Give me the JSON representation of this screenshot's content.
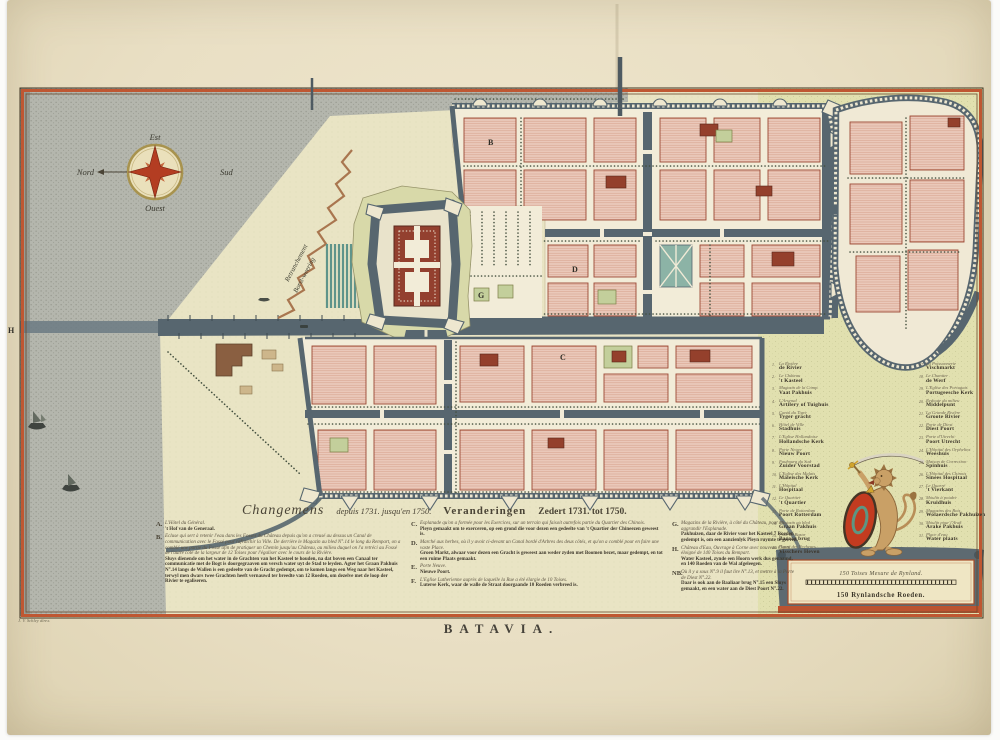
{
  "sheet": {
    "title": "BATAVIA.",
    "signature": "J. V. Schley direx."
  },
  "compass": {
    "east": "Est",
    "north": "Nord",
    "south": "Sud",
    "west": "Ouest"
  },
  "map_labels": {
    "retranchement_fr": "Retranchement",
    "retranchement_nl": "Borst-weering",
    "letter_b": "B",
    "letter_c": "C",
    "letter_d": "D",
    "letter_g": "G",
    "letter_h": "H"
  },
  "changes_block": {
    "header": {
      "fr_script": "Changemens",
      "fr_dates": "depuis 1731. jusqu'en 1750.",
      "nl_word": "Veranderingen",
      "nl_dates": "Zedert 1731. tot 1750."
    },
    "cols": {
      "ab": [
        {
          "letter": "A.",
          "fr": "L'Hôtel du Général.",
          "nl": "'t Hof van de Generaal."
        },
        {
          "letter": "B.",
          "fr": "Ecluse qui sert à retenir l'eau dans les Fossés du Château depuis qu'on a creusé au dessus un Canal de communication avec le Fossé pour rafraichir la Ville. De derrière le Magazin au bled N°.14 le long du Rempart, on a comblé une partie du Fossé afin de pratiquer un Chemin jusqu'au Château, au milieu duquel on l'a retréci au Fossé de l'autre côté de la largeur de 12 Toises pour l'égaliser avec le cours de la Rivière.",
          "nl": "Sluys dienende om het water in de Grachten van het Kasteel te houden, na dat boven een Canaal ter communicatie met de Bogt is doorgegraaven om versch water uyt de Stad te leyden. Agter het Graan Pakhuis N°.14 langs de Wallen is een gedeelte van de Gracht gedempt, om te komen langs een Weg naar het Kasteel, terwyl men dwars twee Grachten heeft vernauwd ter breedte van 12 Roeden, om dezelve met de loop der Rivier te egaliseren."
        }
      ],
      "cf": [
        {
          "letter": "C.",
          "fr": "Esplanade qu'on a formée pour les Exercices, sur un terrain qui faisoit autrefois partie du Quartier des Chinois.",
          "nl": "Pleyn gemaakt om te exerceren, op een grond die voor dezen een gedeelte van 't Quartier der Chineezen geweest is."
        },
        {
          "letter": "D.",
          "fr": "Marché aux herbes, où il y avoit ci-devant un Canal bordé d'Arbres des deux côtés, et qu'on a comblé pour en faire une vaste Place.",
          "nl": "Groen Markt, alwaar voor dezen een Gracht is geweest aan weder zyden met Boomen bezet, maar gedempt, en tot een ruime Plaats gemaakt."
        },
        {
          "letter": "E.",
          "fr": "Porte Neuve.",
          "nl": "Nieuwe Poort."
        },
        {
          "letter": "F.",
          "fr": "L'Eglise Lutherienne auprès de laquelle la Rue a été élargie de 10 Toises.",
          "nl": "Luterse Kerk, waar de walle de Straat doorgaande 10 Roeden verbreed is."
        }
      ],
      "gh": [
        {
          "letter": "G.",
          "fr": "Magazins de la Rivière, à côté du Château, pour en aggrandir l'Esplanade.",
          "nl": "Pakhuizen, daar de Rivier voor het Kasteel 7 Roeden gedempt is, om een aanzienlyk Pleyn ruymte te geeven."
        },
        {
          "letter": "H.",
          "fr": "Château d'Eau, Ouvrage à Corne avec nouveau Canal, éloigné de 140 Toises du Rempart.",
          "nl": "Water Kasteel, zynde een Hoorn werk dus genaamd, en 140 Roeden van de Wal afgeleegen."
        },
        {
          "letter": "NB.",
          "fr": "Où il y a sous N°.9 il faut lire N°.13, et mettre à la Porte de Diest N°.22.",
          "nl": "Daar is ook aan de Baaliaar brug N°.15 een Sluys gemaakt, en een water aan de Diest Poort N°.22."
        }
      ]
    }
  },
  "legend": {
    "left": [
      {
        "n": "1.",
        "fr": "La Rivière",
        "nl": "de Rivier"
      },
      {
        "n": "2.",
        "fr": "Le Château",
        "nl": "'t Kasteel"
      },
      {
        "n": "3.",
        "fr": "Magazin de la Comp.",
        "nl": "Vaat Pakhuis"
      },
      {
        "n": "4.",
        "fr": "L'Arsenal",
        "nl": "Artilery of Tuighuis"
      },
      {
        "n": "5.",
        "fr": "Canal du Tigre",
        "nl": "Tyger gracht"
      },
      {
        "n": "6.",
        "fr": "Hôtel de Ville",
        "nl": "Stadhuis"
      },
      {
        "n": "7.",
        "fr": "L'Eglise Hollandoise",
        "nl": "Hollandsche Kerk"
      },
      {
        "n": "8.",
        "fr": "Porte Neuve",
        "nl": "Nieuw Poort"
      },
      {
        "n": "9.",
        "fr": "Faubourg du Sud",
        "nl": "Zuider Voorstad"
      },
      {
        "n": "10.",
        "fr": "L'Eglise des Malais",
        "nl": "Maleische Kerk"
      },
      {
        "n": "11.",
        "fr": "L'Hôpital",
        "nl": "Hospitaal"
      },
      {
        "n": "12.",
        "fr": "Le Quartier",
        "nl": "'t Quartier"
      },
      {
        "n": "13.",
        "fr": "Porte de Rotterdam",
        "nl": "Poort Rotterdam"
      },
      {
        "n": "14.",
        "fr": "Magazin au bled",
        "nl": "Graan Pakhuis"
      },
      {
        "n": "15.",
        "fr": "Pont du Bazar",
        "nl": "Bazaar brug"
      },
      {
        "n": "16.",
        "fr": "Havre des Pecheurs",
        "nl": "Visschers Heven"
      }
    ],
    "right": [
      {
        "n": "17.",
        "fr": "La Poissonnerie",
        "nl": "Vischmarkt"
      },
      {
        "n": "18.",
        "fr": "Le Chantier",
        "nl": "de Werf"
      },
      {
        "n": "19.",
        "fr": "L'Eglise des Portugais",
        "nl": "Portugeesche Kerk"
      },
      {
        "n": "20.",
        "fr": "Redoute du milieu",
        "nl": "Middelpunt"
      },
      {
        "n": "21.",
        "fr": "La Grande Rivière",
        "nl": "Groote Rivier"
      },
      {
        "n": "22.",
        "fr": "Porte de Diest",
        "nl": "Diest Poort"
      },
      {
        "n": "23.",
        "fr": "Porte d'Utrecht",
        "nl": "Poort Utrecht"
      },
      {
        "n": "24.",
        "fr": "L'Hôpital des Orphelins",
        "nl": "Weeshuis"
      },
      {
        "n": "25.",
        "fr": "Maison de Correction",
        "nl": "Spinhuis"
      },
      {
        "n": "26.",
        "fr": "L'Hôpital des Chinois",
        "nl": "Sinees Hospitaal"
      },
      {
        "n": "27.",
        "fr": "Le Quarré",
        "nl": "'t Vierkant"
      },
      {
        "n": "28.",
        "fr": "Moulin à poudre",
        "nl": "Kruidhuis"
      },
      {
        "n": "29.",
        "fr": "Magazins des Bois",
        "nl": "Wolaerdsche Pakhuizen"
      },
      {
        "n": "30.",
        "fr": "Moulin pour l'Arak",
        "nl": "Arake Pakhuis"
      },
      {
        "n": "31.",
        "fr": "Place d'eau",
        "nl": "Water plaats"
      }
    ]
  },
  "scale_bar": {
    "fr": "150 Toises Mesure de Rynland.",
    "nl": "150 Rynlandsche Roeden."
  },
  "colors": {
    "border": "#bf5732",
    "sea": "#b4b6ad",
    "canal": "#57666f",
    "block": "#eac9ba",
    "accent_red": "#b33d22"
  }
}
